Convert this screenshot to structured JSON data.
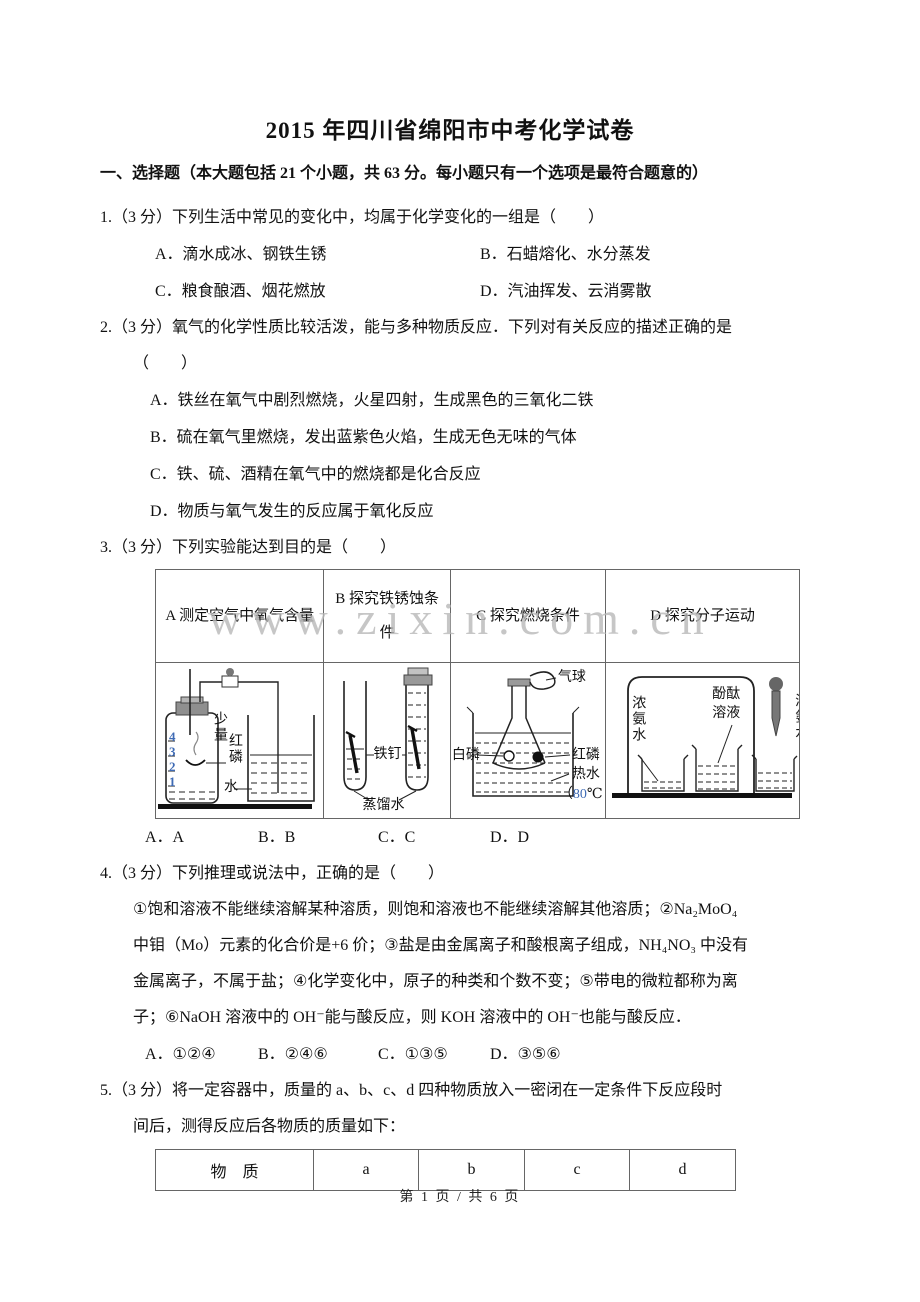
{
  "page": {
    "title": "2015 年四川省绵阳市中考化学试卷",
    "watermark": "www.zixin.com.cn",
    "footer": "第 1 页 / 共 6 页"
  },
  "section_heading": "一、选择题（本大题包括 21 个小题，共 63 分。每小题只有一个选项是最符合题意的）",
  "q1": {
    "prefix": "1.（3 分）",
    "stem": "下列生活中常见的变化中，均属于化学变化的一组是（　　）",
    "options": [
      "A．滴水成冰、钢铁生锈",
      "B．石蜡熔化、水分蒸发",
      "C．粮食酿酒、烟花燃放",
      "D．汽油挥发、云消雾散"
    ]
  },
  "q2": {
    "prefix": "2.（3 分）",
    "stem_line1": "氧气的化学性质比较活泼，能与多种物质反应．下列对有关反应的描述正确的是",
    "stem_line2": "（　　）",
    "options": [
      "A．铁丝在氧气中剧烈燃烧，火星四射，生成黑色的三氧化二铁",
      "B．硫在氧气里燃烧，发出蓝紫色火焰，生成无色无味的气体",
      "C．铁、硫、酒精在氧气中的燃烧都是化合反应",
      "D．物质与氧气发生的反应属于氧化反应"
    ]
  },
  "q3": {
    "prefix": "3.（3 分）",
    "stem": "下列实验能达到目的是（　　）",
    "col_a": {
      "header": "A 测定空气中氧气含量",
      "labels": {
        "scale": "4\n3\n2\n1",
        "shaoliang": "少量",
        "honglin": "红磷",
        "shui": "水"
      }
    },
    "col_b": {
      "header": "B 探究铁锈蚀条件",
      "labels": {
        "nail": "铁钉",
        "distilled_water": "蒸馏水"
      }
    },
    "col_c": {
      "header": "C 探究燃烧条件",
      "labels": {
        "balloon": "气球",
        "white_p": "白磷",
        "red_p": "红磷",
        "hot_water": "热水",
        "temp_pre": "（",
        "temp_num": "80",
        "temp_unit": "℃"
      }
    },
    "col_d": {
      "header": "D 探究分子运动",
      "labels": {
        "ammonia": "浓氨水",
        "phenolphthalein": "酚酞\n溶液",
        "edge_cut": "浓氨水"
      }
    },
    "options": [
      "A．A",
      "B．B",
      "C．C",
      "D．D"
    ]
  },
  "q4": {
    "prefix": "4.（3 分）",
    "stem": "下列推理或说法中，正确的是（　　）",
    "body_lines": [
      "①饱和溶液不能继续溶解某种溶质，则饱和溶液也不能继续溶解其他溶质；②Na₂MoO₄",
      "中钼（Mo）元素的化合价是+6 价；③盐是由金属离子和酸根离子组成，NH₄NO₃ 中没有",
      "金属离子，不属于盐；④化学变化中，原子的种类和个数不变；⑤带电的微粒都称为离",
      "子；⑥NaOH 溶液中的 OH⁻能与酸反应，则 KOH 溶液中的 OH⁻也能与酸反应．"
    ],
    "options": [
      "A．①②④",
      "B．②④⑥",
      "C．①③⑤",
      "D．③⑤⑥"
    ]
  },
  "q5": {
    "prefix": "5.（3 分）",
    "stem_line1": "将一定容器中，质量的 a、b、c、d 四种物质放入一密闭在一定条件下反应段时",
    "stem_line2": "间后，测得反应后各物质的质量如下：",
    "table_headers": [
      "物　质",
      "a",
      "b",
      "c",
      "d"
    ]
  }
}
